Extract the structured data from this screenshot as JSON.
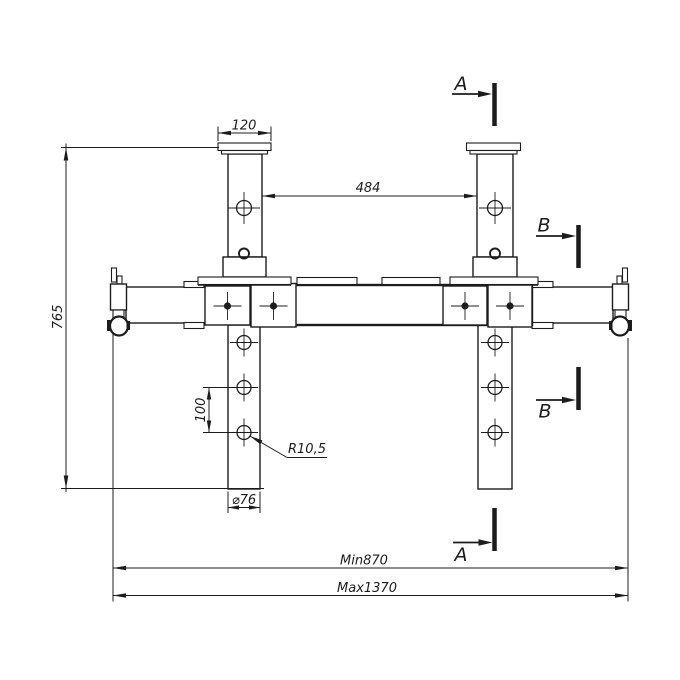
{
  "colors": {
    "line": "#1c1c1c",
    "background": "#ffffff"
  },
  "labels": {
    "cap_width": "120",
    "tower_spacing": "484",
    "overall_height": "765",
    "hole_pitch": "100",
    "hole_radius": "R10,5",
    "tube_width": "⌀76",
    "min_length": "Min870",
    "max_length": "Max1370"
  },
  "sections": {
    "a_top": "A",
    "a_bottom": "A",
    "b_top": "B",
    "b_bottom": "B"
  }
}
